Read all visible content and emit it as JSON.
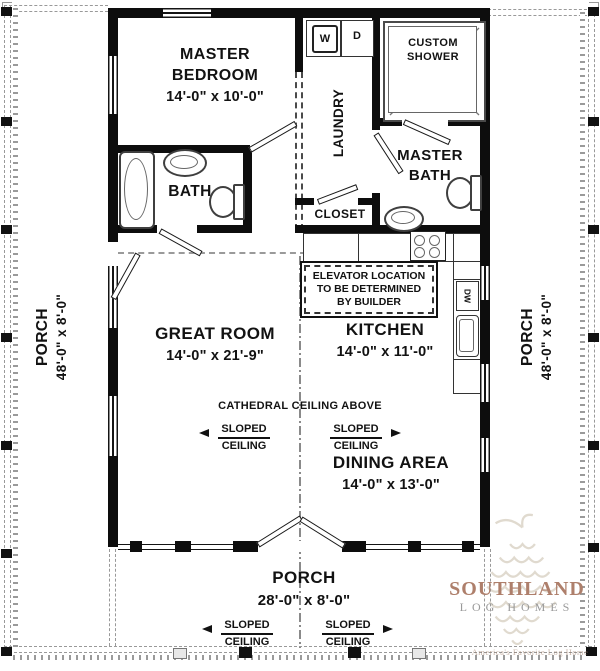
{
  "plan": {
    "rooms": {
      "master_bedroom": {
        "name1": "MASTER",
        "name2": "BEDROOM",
        "dims": "14'-0\" x 10'-0\""
      },
      "laundry": {
        "name": "LAUNDRY"
      },
      "custom_shower": {
        "name1": "CUSTOM",
        "name2": "SHOWER"
      },
      "master_bath": {
        "name1": "MASTER",
        "name2": "BATH"
      },
      "bath": {
        "name": "BATH"
      },
      "closet": {
        "name": "CLOSET"
      },
      "great_room": {
        "name": "GREAT ROOM",
        "dims": "14'-0\" x 21'-9\""
      },
      "kitchen": {
        "name": "KITCHEN",
        "dims": "14'-0\" x 11'-0\""
      },
      "dining_area": {
        "name": "DINING AREA",
        "dims": "14'-0\" x 13'-0\""
      },
      "porch_left": {
        "name": "PORCH",
        "dims": "48'-0\" x 8'-0\""
      },
      "porch_right": {
        "name": "PORCH",
        "dims": "48'-0\" x 8'-0\""
      },
      "porch_front": {
        "name": "PORCH",
        "dims": "28'-0\" x 8'-0\""
      }
    },
    "notes": {
      "elevator_line1": "ELEVATOR LOCATION",
      "elevator_line2": "TO BE DETERMINED",
      "elevator_line3": "BY BUILDER",
      "cathedral": "CATHEDRAL CEILING ABOVE",
      "sloped_line1": "SLOPED",
      "sloped_line2": "CEILING"
    },
    "appliances": {
      "washer": "W",
      "dryer": "D",
      "dishwasher": "DW"
    }
  },
  "logo": {
    "brand": "SOUTHLAND",
    "sub": "LOG HOMES",
    "tagline": "America's Favorite Log Home",
    "brand_color": "#ae7f6b",
    "sub_color": "#9a9a9a"
  },
  "colors": {
    "wall": "#0d0d0d",
    "dash": "#999999"
  }
}
